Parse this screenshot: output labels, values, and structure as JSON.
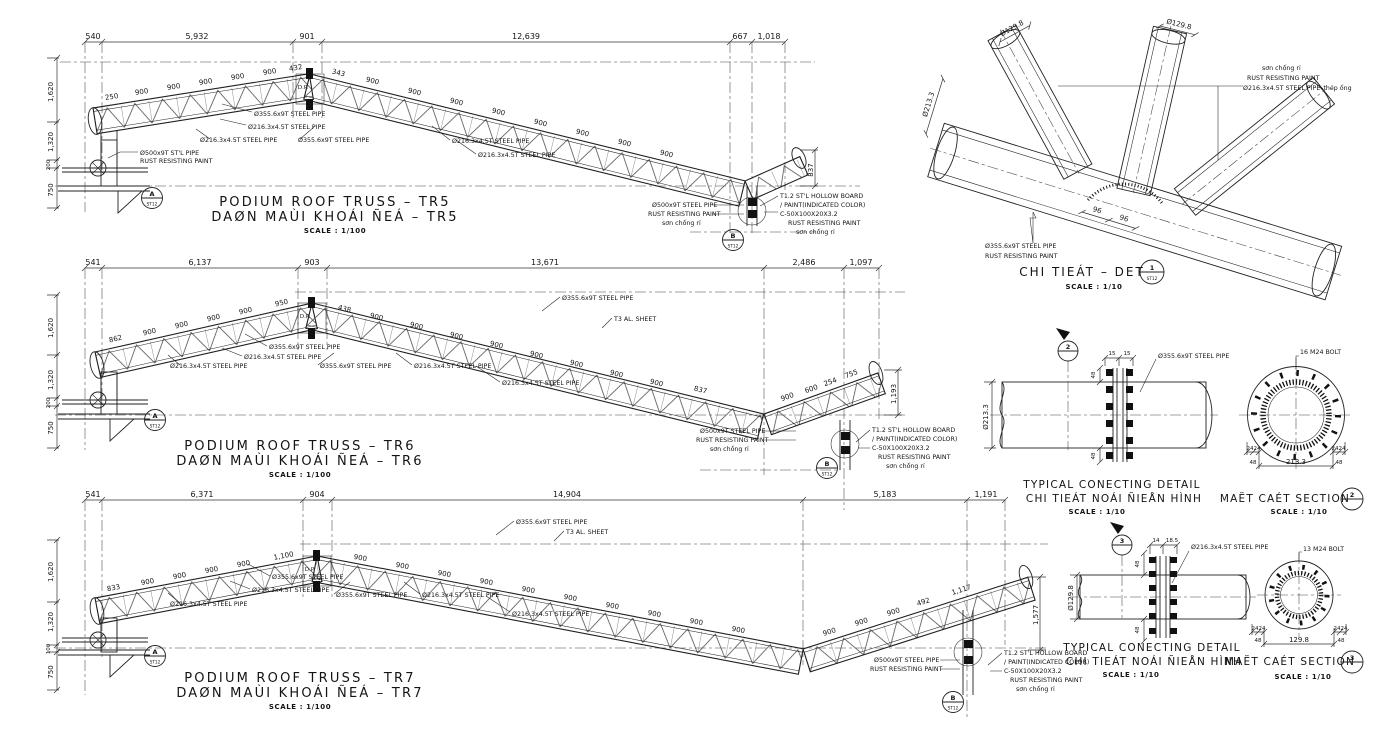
{
  "s": {
    "seg900": "900",
    "pipe355": "Ø355.6x9T STEEL PIPE",
    "pipe216": "Ø216.3x4.5T STEEL PIPE",
    "pipe500": "Ø500x9T STEEL PIPE",
    "pipe500stl": "Ø500x9T ST'L PIPE",
    "rust": "RUST RESISTING PAINT",
    "son": "sơn chống rỉ",
    "board1": "T1.2 ST'L HOLLOW BOARD",
    "board2": "/ PAINT(INDICATED COLOR)",
    "channel": "C-50X100X20X3.2",
    "alsheet": "T3 AL. SHEET",
    "scale100": "SCALE : 1/100",
    "scale10": "SCALE : 1/10",
    "dp": "D.P.",
    "sheet": "ST12"
  },
  "tr5": {
    "title_en": "PODIUM ROOF TRUSS – TR5",
    "title_vi": "DAØN MAÙI KHOÁI ÑEÁ – TR5",
    "top_dims": [
      "540",
      "5,932",
      "901",
      "12,639",
      "667",
      "1,018"
    ],
    "left_dims": [
      "1,620",
      "1,320",
      "200",
      "750"
    ],
    "seg_first": "250",
    "apex_l": "432",
    "apex_r": "343",
    "end_dim": "837",
    "ca": "A",
    "cb": "B"
  },
  "tr6": {
    "title_en": "PODIUM ROOF TRUSS – TR6",
    "title_vi": "DAØN MAÙI KHOÁI ÑEÁ – TR6",
    "top_dims": [
      "541",
      "6,137",
      "903",
      "13,671",
      "2,486",
      "1,097"
    ],
    "left_dims": [
      "1,620",
      "1,320",
      "200",
      "750"
    ],
    "seg_first": "862",
    "apex_l": "950",
    "apex_r": "438",
    "valley": "837",
    "t600": "600",
    "t254": "254",
    "t755": "755",
    "end_dim": "1,193",
    "ca": "A",
    "cb": "B"
  },
  "tr7": {
    "title_en": "PODIUM ROOF TRUSS – TR7",
    "title_vi": "DAØN MAÙI KHOÁI ÑEÁ – TR7",
    "top_dims": [
      "541",
      "6,371",
      "904",
      "14,904",
      "5,183",
      "1,191"
    ],
    "left_dims": [
      "1,620",
      "1,320",
      "100",
      "750"
    ],
    "seg_first": "833",
    "apex_l": "1,100",
    "t492": "492",
    "t1117": "1,117",
    "end_dim": "1,577",
    "ca": "A",
    "cb": "B"
  },
  "joint": {
    "title": "CHI TIEÁT – DET",
    "bubble": "1",
    "d96": "96",
    "brace": "Ø129.8",
    "chord": "Ø213.3",
    "n3": "Ø216.3x4.5T STEEL PIPE–thép ống"
  },
  "det": {
    "title1": "TYPICAL CONECTING DETAIL",
    "title2": "CHI TIEÁT NOÁI ÑIEÅN HÌNH",
    "sect": "MAËT CAÉT SECTION"
  },
  "det2": {
    "num": "2",
    "f1": "15",
    "f2": "15",
    "d48": "48",
    "dia": "Ø213.3",
    "bolt": "16 M24 BOLT",
    "s24": "24",
    "sw": "213.3"
  },
  "det3": {
    "num": "3",
    "f1": "14",
    "f2": "18.5",
    "d48": "48",
    "dia": "Ø129.8",
    "bolt": "13 M24 BOLT",
    "s24": "24",
    "sw": "129.8"
  }
}
